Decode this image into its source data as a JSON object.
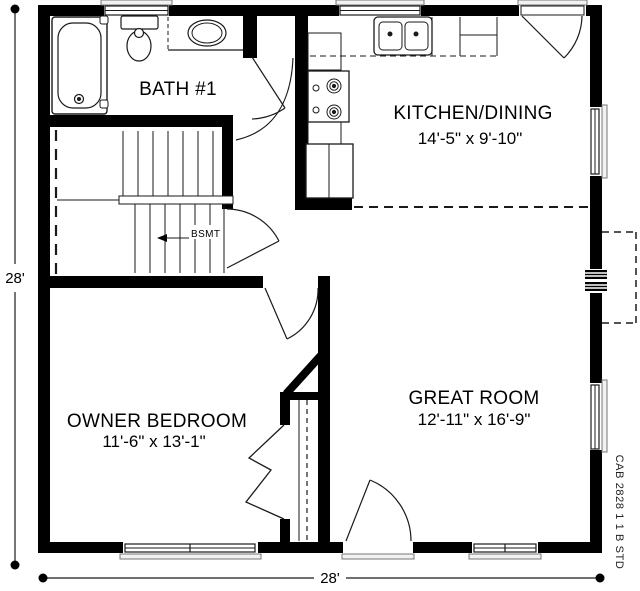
{
  "plan": {
    "code": "CAB 2828 1 1 B STD",
    "basement_label": "BSMT",
    "rooms": {
      "bath": {
        "name": "BATH #1"
      },
      "kitchen_dining": {
        "name": "KITCHEN/DINING",
        "dims": "14'-5\" x 9'-10\""
      },
      "owner_bedroom": {
        "name": "OWNER BEDROOM",
        "dims": "11'-6\" x 13'-1\""
      },
      "great_room": {
        "name": "GREAT ROOM",
        "dims": "12'-11\" x 16'-9\""
      }
    },
    "dimensions": {
      "left": "28'",
      "bottom": "28'"
    },
    "colors": {
      "wall": "#000000",
      "line": "#1a1a1a",
      "sill_fill": "#f2f2f2",
      "sill_stroke": "#777777",
      "background": "#ffffff"
    }
  }
}
